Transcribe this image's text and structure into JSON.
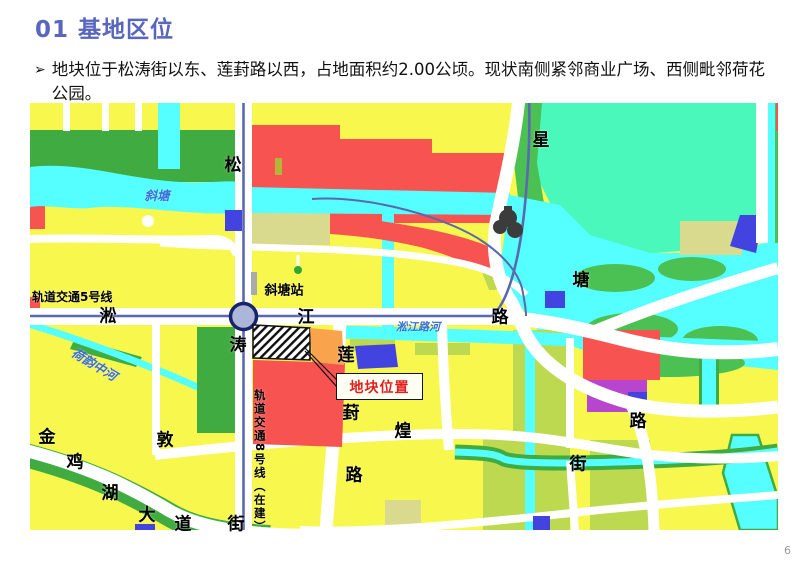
{
  "header": {
    "title": "01 基地区位"
  },
  "body": {
    "bullet_marker": "➢",
    "text": "地块位于松涛街以东、莲葑路以西，占地面积约2.00公顷。现状南侧紧邻商业广场、西侧毗邻荷花公园。"
  },
  "page": {
    "number": "6"
  },
  "map": {
    "labels": {
      "rail5": "轨道交通5号线",
      "rail8": "轨道交通8号线（在建）",
      "station": "斜塘站",
      "site_callout": "地块位置",
      "river_xietang": "斜塘",
      "river_songjiang": "淞江路河",
      "river_heyun": "荷韵中河",
      "songtao": [
        "松",
        "涛",
        "街"
      ],
      "songjiang": [
        "淞",
        "江",
        "路"
      ],
      "xingtang": [
        "星",
        "塘",
        "路"
      ],
      "lianfeng": [
        "莲",
        "葑",
        "路"
      ],
      "dunhuang": [
        "敦",
        "煌",
        "街"
      ],
      "jinjihu": [
        "金",
        "鸡",
        "湖",
        "大",
        "道"
      ]
    },
    "colors": {
      "residential_yellow": "#F7F74E",
      "mixed_yellow_green": "#BCD94F",
      "khaki": "#D9DA8E",
      "green_space": "#3FAB40",
      "bright_green": "#4CC153",
      "park_aquamarine": "#4AF8BC",
      "water_cyan": "#55FFFF",
      "commercial_red": "#F75351",
      "orange": "#F9A44D",
      "blue": "#4343DF",
      "purple": "#B845CE",
      "rail_line": "#5B68B0",
      "road_white": "#FFFFFF",
      "station_fill": "#ACB6D8",
      "callout_red": "#E01F1F",
      "title_blue": "#5866BE"
    }
  }
}
